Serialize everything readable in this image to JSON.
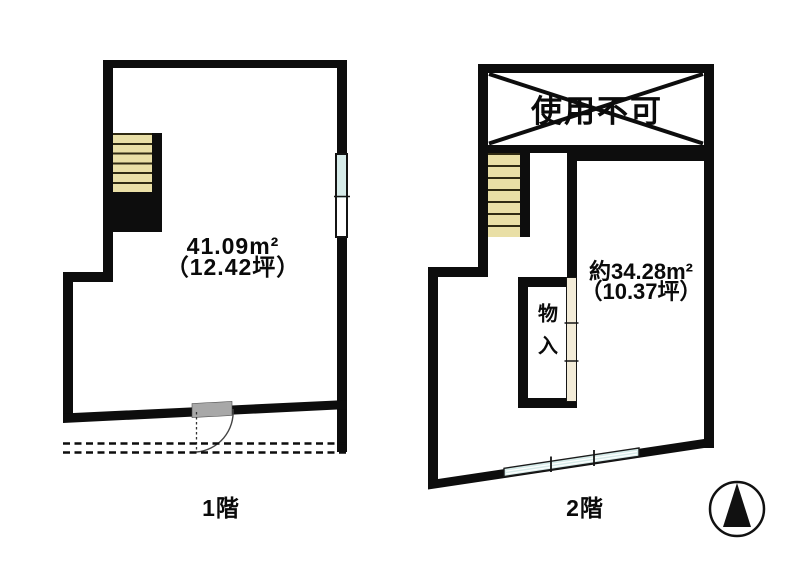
{
  "floor1": {
    "label": "1階",
    "area": "41.09m²",
    "area_tsubo": "（12.42坪）"
  },
  "floor2": {
    "label": "2階",
    "area": "約34.28m²",
    "area_tsubo": "（10.37坪）",
    "unusable_label": "使用不可",
    "closet_label": "物入"
  },
  "icons": {
    "compass": "north-arrow"
  },
  "colors": {
    "wall": "#0d0d0d",
    "stair_tread": "#e9dfa6",
    "window_glass": "#d6ebe9",
    "door_leaf": "#a8a8a8",
    "background": "#ffffff"
  }
}
